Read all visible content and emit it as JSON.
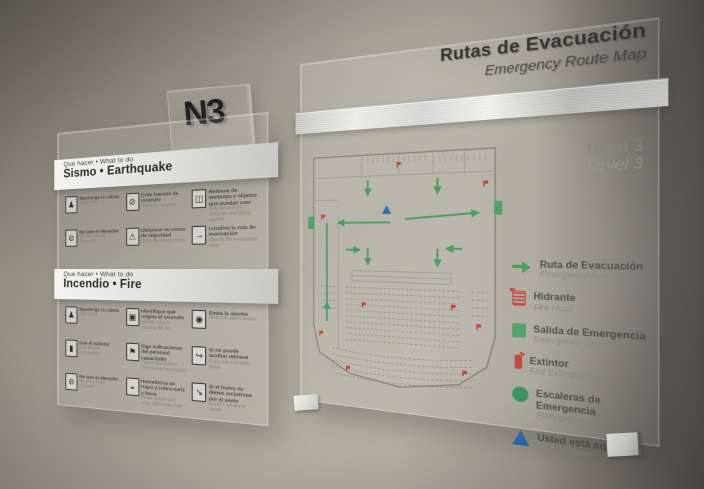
{
  "n3_sign": {
    "label": "N3"
  },
  "left_sign": {
    "sections": [
      {
        "id": "earthquake",
        "header_line1": "Que hacer • What to do",
        "header_line2": "Sismo • Earthquake",
        "items": [
          {
            "icon": "person-calm-icon",
            "glyph": "♟",
            "es": "Mantenga la calma",
            "en": "Stay calm"
          },
          {
            "icon": "no-fire-sources-icon",
            "glyph": "⊘",
            "es": "Evite fuentes de incendio",
            "en": "Avoid fire sources"
          },
          {
            "icon": "falling-objects-icon",
            "glyph": "◫",
            "es": "Retírese de ventanas y objetos que puedan caer",
            "en": "Stay away from windows and falling objects"
          },
          {
            "icon": "no-elevator-icon",
            "glyph": "⊘",
            "es": "No use el elevador",
            "en": "Do not use the elevator"
          },
          {
            "icon": "safety-zone-icon",
            "glyph": "⚠",
            "es": "Ubíquese en zonas de seguridad",
            "en": "Go to the safety zones"
          },
          {
            "icon": "route-exit-icon",
            "glyph": "→",
            "es": "Localice la ruta de evacuación",
            "en": "Identify the evacuation route"
          }
        ]
      },
      {
        "id": "fire",
        "header_line1": "Que hacer • What to do",
        "header_line2": "Incendio • Fire",
        "items": [
          {
            "icon": "person-calm-icon",
            "glyph": "♟",
            "es": "Mantenga la calma",
            "en": "Stay calm"
          },
          {
            "icon": "fire-origin-icon",
            "glyph": "▣",
            "es": "Identifique qué origina el incendio",
            "en": "Identify what is causing the fire"
          },
          {
            "icon": "alarm-button-icon",
            "glyph": "◉",
            "es": "Emita la alarma",
            "en": "Push the alarm button"
          },
          {
            "icon": "extinguisher-use-icon",
            "glyph": "▮",
            "es": "Use el extintor",
            "en": "Use the fire extinguisher"
          },
          {
            "icon": "follow-staff-icon",
            "glyph": "⚑",
            "es": "Siga indicaciones del personal capacitado",
            "en": "Follow instructions from trained personnel"
          },
          {
            "icon": "leave-if-no-help-icon",
            "glyph": "↪",
            "es": "Si no puede auxiliar retírese",
            "en": "If you can not help, leave"
          },
          {
            "icon": "no-elevator-icon",
            "glyph": "⊘",
            "es": "No use el elevador",
            "en": "Do not use the elevator"
          },
          {
            "icon": "wet-cloth-icon",
            "glyph": "◒",
            "es": "Humedezca un trapo y cubra nariz y boca",
            "en": "Cover mouth and nose with a wet cloth"
          },
          {
            "icon": "crawl-low-icon",
            "glyph": "↘",
            "es": "Si el humo es denso arrástrese por el suelo",
            "en": "Crawl if smoke is dense"
          }
        ]
      }
    ]
  },
  "right_sign": {
    "title_es": "Rutas de Evacuación",
    "title_en": "Emergency Route Map",
    "level_es": "Nivel 3",
    "level_en": "Level 3",
    "legend": [
      {
        "icon": "route-arrow-icon",
        "color": "#4a9e63",
        "es": "Ruta de Evacuación",
        "en": "Emergency Route"
      },
      {
        "icon": "hydrant-icon",
        "color": "#c4524a",
        "es": "Hidrante",
        "en": "Fire Hose"
      },
      {
        "icon": "exit-square-icon",
        "color": "#52a06b",
        "es": "Salida de Emergencia",
        "en": "Emergency Exit"
      },
      {
        "icon": "extinguisher-icon",
        "color": "#bf4a3e",
        "es": "Extintor",
        "en": "Fire Extinguisher"
      },
      {
        "icon": "stairs-circle-icon",
        "color": "#3f9360",
        "es": "Escaleras de Emergencia",
        "en": "Emergency Stairs"
      },
      {
        "icon": "you-are-here-triangle-icon",
        "color": "#2e6db4",
        "es": "Usted está aquí",
        "en": "You are here"
      }
    ]
  },
  "colors": {
    "route_green": "#4a9e63",
    "alarm_red": "#c0453c",
    "here_blue": "#2e6db4",
    "plan_gray": "#85857e"
  }
}
